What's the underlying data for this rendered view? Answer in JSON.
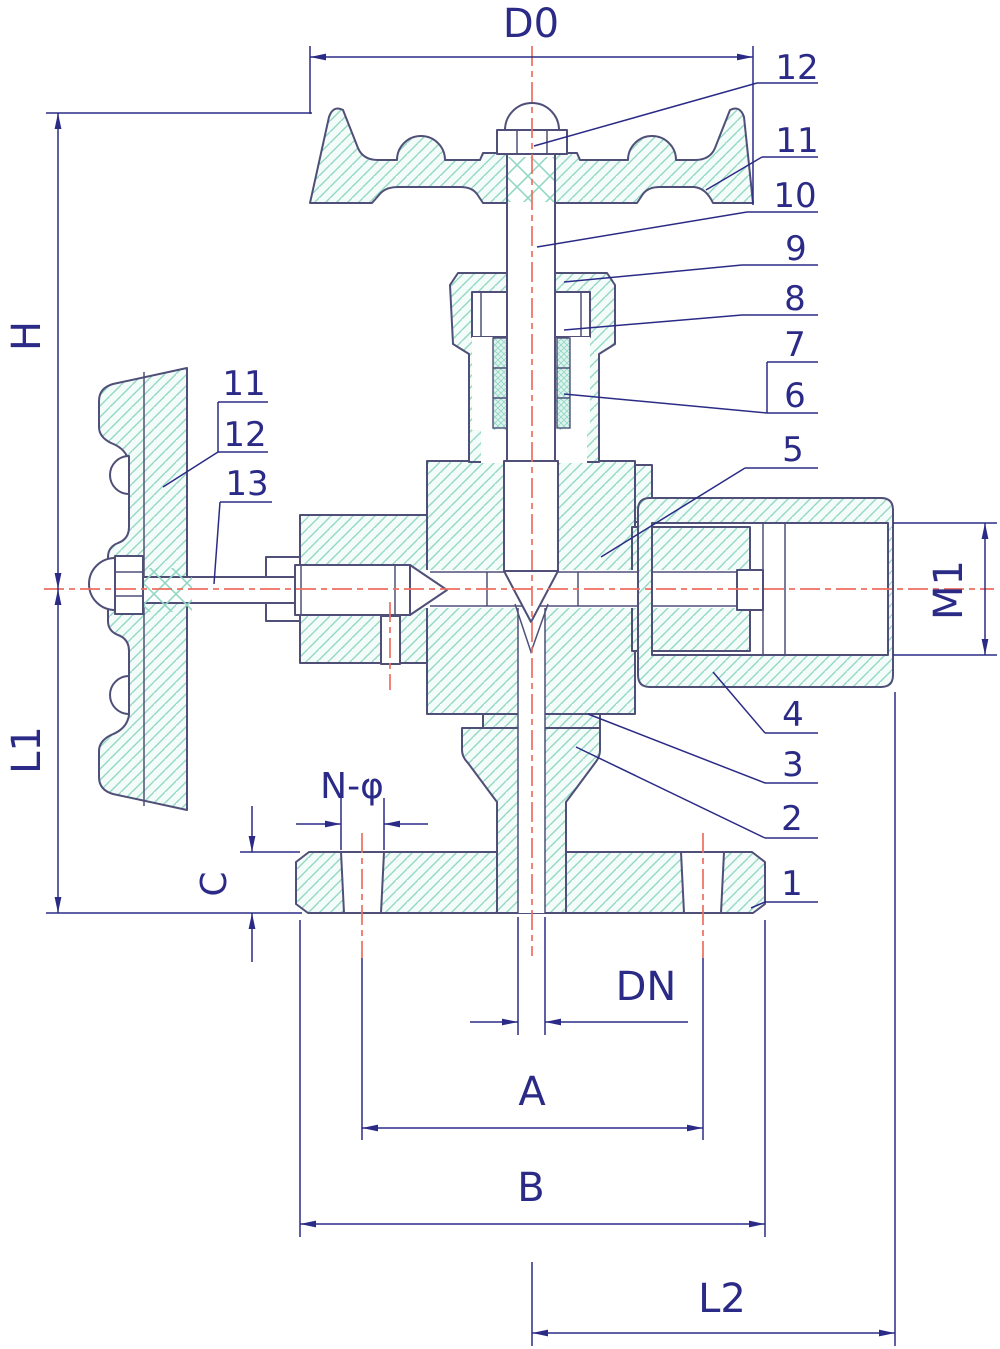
{
  "drawing": {
    "kind": "angle needle valve cross-section technical drawing",
    "colors": {
      "outline": "#4f4f78",
      "dim": "#2b2b87",
      "centerline": "#ee6e60",
      "hatch": "#93d7c4",
      "hatchFill": "#f3fcf9",
      "packingFill": "#dff4ef"
    },
    "dimensions": {
      "d0": "D0",
      "h": "H",
      "l1": "L1",
      "m1": "M1",
      "c": "C",
      "n_phi": "N-φ",
      "dn": "DN",
      "a": "A",
      "b": "B",
      "l2": "L2"
    },
    "parts_right": {
      "p12": "12",
      "p11": "11",
      "p10": "10",
      "p9": "9",
      "p8": "8",
      "p7": "7",
      "p6": "6",
      "p5": "5",
      "p4": "4",
      "p3": "3",
      "p2": "2",
      "p1": "1"
    },
    "parts_left": {
      "p11": "11",
      "p12": "12",
      "p13": "13"
    }
  }
}
